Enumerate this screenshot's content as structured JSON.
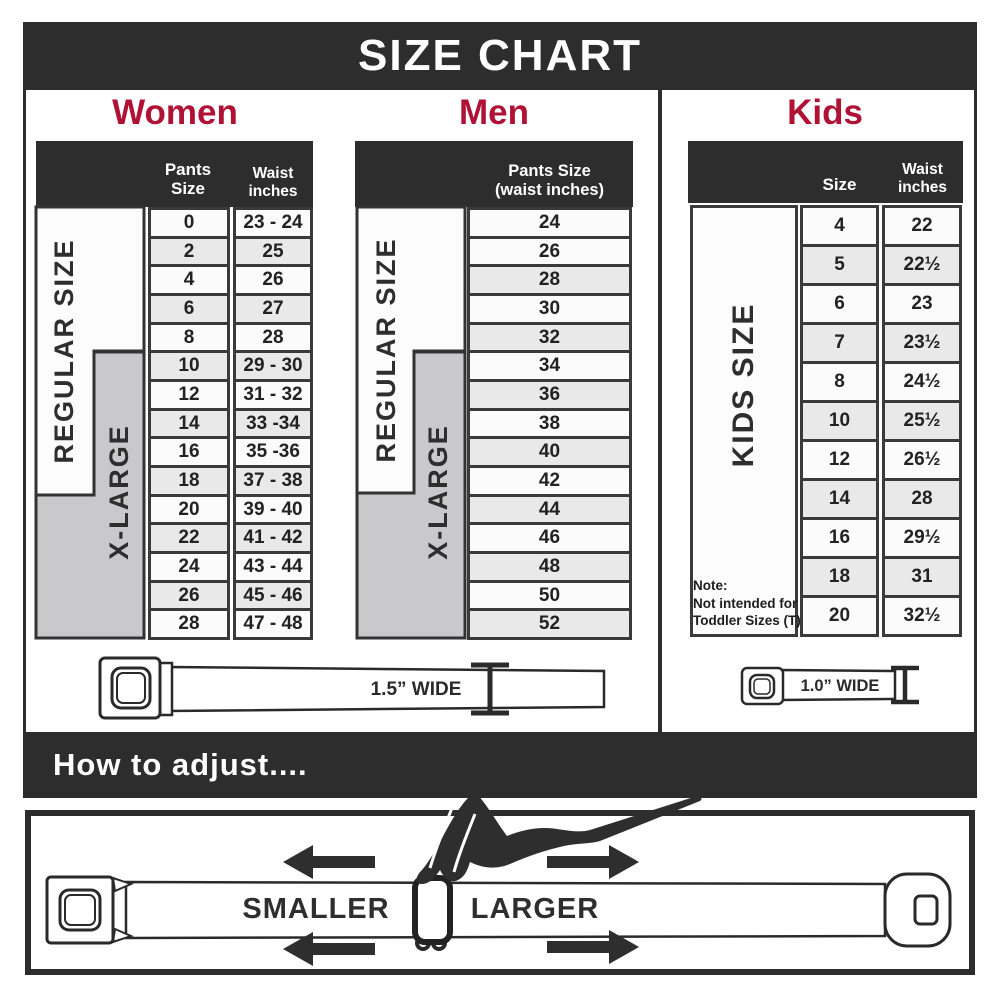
{
  "title": "SIZE CHART",
  "sections": {
    "women": {
      "heading": "Women",
      "col_pants": "Pants Size",
      "col_waist_line1": "Waist",
      "col_waist_line2": "inches",
      "regular_label": "REGULAR SIZE",
      "xlarge_label": "X-LARGE",
      "rows": [
        {
          "size": "0",
          "waist": "23 - 24"
        },
        {
          "size": "2",
          "waist": "25"
        },
        {
          "size": "4",
          "waist": "26"
        },
        {
          "size": "6",
          "waist": "27"
        },
        {
          "size": "8",
          "waist": "28"
        },
        {
          "size": "10",
          "waist": "29 - 30"
        },
        {
          "size": "12",
          "waist": "31 - 32"
        },
        {
          "size": "14",
          "waist": "33 -34"
        },
        {
          "size": "16",
          "waist": "35 -36"
        },
        {
          "size": "18",
          "waist": "37 - 38"
        },
        {
          "size": "20",
          "waist": "39 - 40"
        },
        {
          "size": "22",
          "waist": "41 - 42"
        },
        {
          "size": "24",
          "waist": "43 - 44"
        },
        {
          "size": "26",
          "waist": "45 - 46"
        },
        {
          "size": "28",
          "waist": "47 - 48"
        }
      ]
    },
    "men": {
      "heading": "Men",
      "col_line1": "Pants Size",
      "col_line2": "(waist inches)",
      "regular_label": "REGULAR SIZE",
      "xlarge_label": "X-LARGE",
      "sizes": [
        "24",
        "26",
        "28",
        "30",
        "32",
        "34",
        "36",
        "38",
        "40",
        "42",
        "44",
        "46",
        "48",
        "50",
        "52"
      ]
    },
    "kids": {
      "heading": "Kids",
      "col_size": "Size",
      "col_waist_line1": "Waist",
      "col_waist_line2": "inches",
      "side_label": "KIDS SIZE",
      "note": [
        "Note:",
        "Not intended for",
        "Toddler Sizes (T)"
      ],
      "rows": [
        {
          "size": "4",
          "waist": "22"
        },
        {
          "size": "5",
          "waist": "22½"
        },
        {
          "size": "6",
          "waist": "23"
        },
        {
          "size": "7",
          "waist": "23½"
        },
        {
          "size": "8",
          "waist": "24½"
        },
        {
          "size": "10",
          "waist": "25½"
        },
        {
          "size": "12",
          "waist": "26½"
        },
        {
          "size": "14",
          "waist": "28"
        },
        {
          "size": "16",
          "waist": "29½"
        },
        {
          "size": "18",
          "waist": "31"
        },
        {
          "size": "20",
          "waist": "32½"
        }
      ]
    }
  },
  "belts": {
    "adult_label": "1.5” WIDE",
    "kids_label": "1.0” WIDE"
  },
  "adjust": {
    "heading": "How to adjust....",
    "smaller": "SMALLER",
    "larger": "LARGER"
  },
  "colors": {
    "charcoal": "#2D2D2D",
    "crimson": "#B01236",
    "row_light": "#FBFBFB",
    "row_shaded": "#E9E9EA",
    "label_grey": "#C9C9CB"
  }
}
